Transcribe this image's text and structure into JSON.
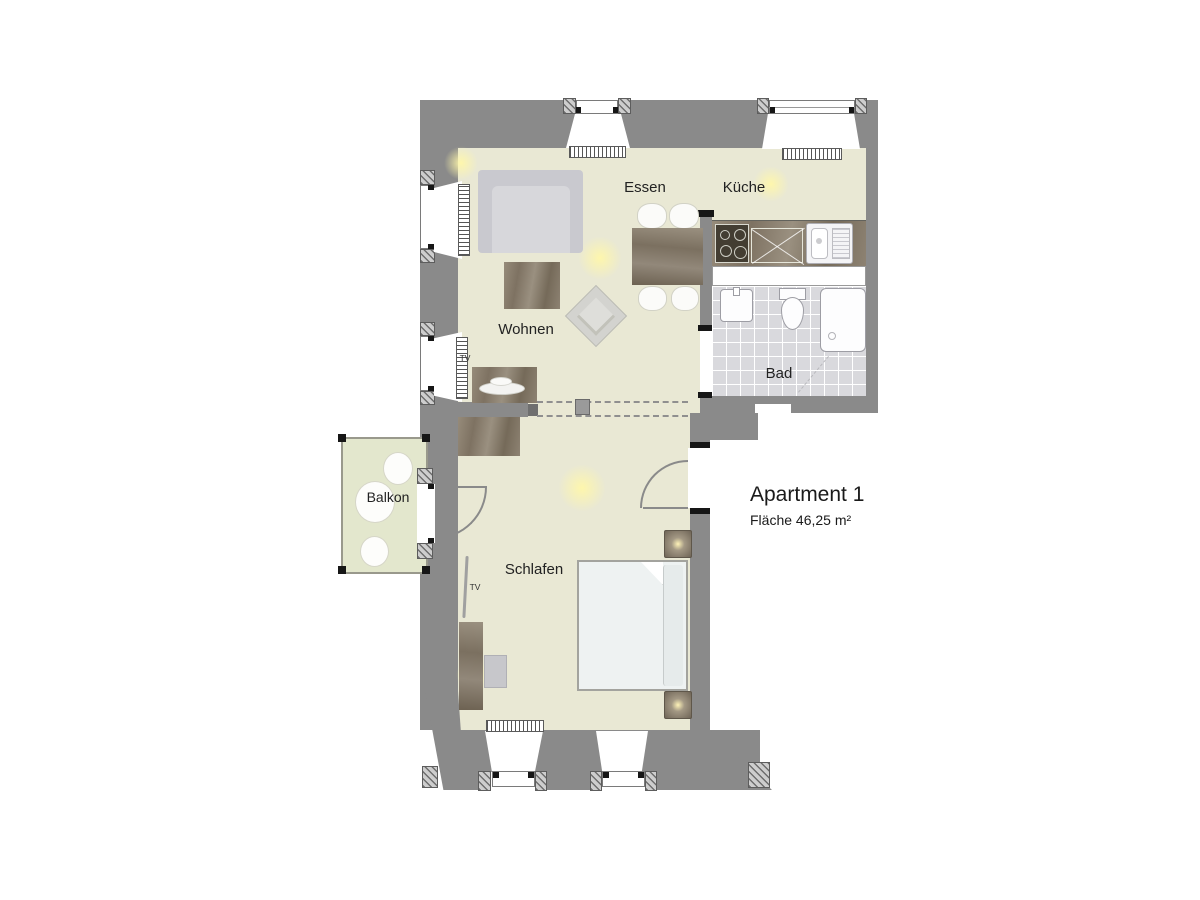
{
  "title": {
    "name": "Apartment 1",
    "area": "Fläche 46,25 m²"
  },
  "rooms": {
    "living": "Wohnen",
    "dining": "Essen",
    "kitchen": "Küche",
    "bath": "Bad",
    "bedroom": "Schlafen",
    "balcony": "Balkon"
  },
  "labels": {
    "tv_living": "TV",
    "tv_bedroom": "TV"
  },
  "colors": {
    "wall": "#8a8a8a",
    "floor": "#e9e8d4",
    "balcony_floor": "#e3e7cd",
    "bath_floor": "#d9d9dd",
    "wood": "#867b6a",
    "window_white": "#ffffff",
    "glow": "#fff7b0",
    "text": "#222222"
  }
}
